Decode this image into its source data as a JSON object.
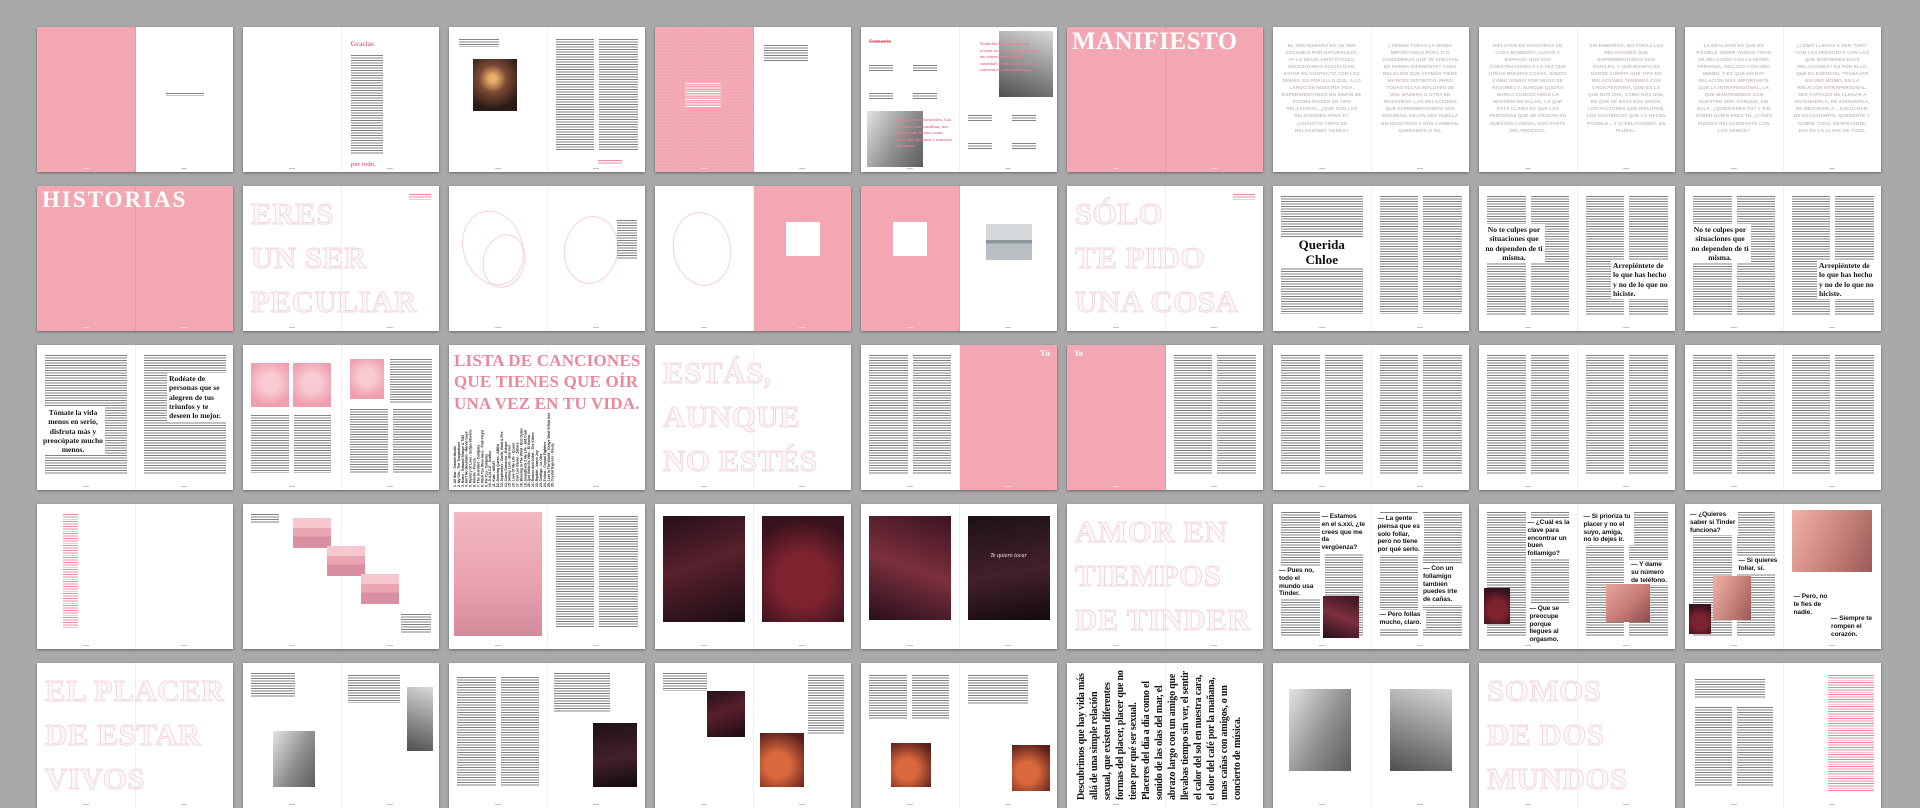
{
  "board": {
    "view": "spread-grid-overview",
    "rows": 5,
    "cols": 9
  },
  "colors": {
    "canvas_grey": "#a9a9aa",
    "page_white": "#ffffff",
    "brand_pink": "#f3a7b3",
    "rose_text": "#e0798b",
    "headline_rose": "#ec7d93",
    "pale_caps": "#c9bbbe",
    "ink": "#141414"
  },
  "spreads": {
    "r1c2": {
      "title": "Gracias",
      "closing": "por todo,"
    },
    "r1c5": {
      "heading": "Sumario",
      "left_note": "Somos seres relacionales. Las relaciones nos cambian, nos construyen. Somos como somos por los lazos y nuestras relaciones.",
      "right_note": "Todas las historias de esta revista son vivencias reales que nos muestran la amplia variedad de relaciones que nos construyen como personas."
    },
    "r1c6": {
      "title": "MANIFIESTO"
    },
    "r1c7": {
      "left": "EL SER HUMANO ES UN SER SOCIABLE POR NATURALEZA. YA LO DECÍA ARISTÓTELES. NECESITAMOS SOCIALIZAR, ESTAR EN CONTACTO CON LOS DEMÁS. ES POR ELLO QUE, A LO LARGO DE NUESTRA VIDA, EXPERIMENTAMOS UN SINFÍN DE POSIBILIDADES DE TIPO RELACIONAL. ¿QUÉ SON LAS RELACIONES PARA TI? ¿CUÁNTOS TIPOS DE RELACIONES TIENES?",
      "right": "¿TIENEN TODAS LA MISMA IMPORTANCIA PARA TI O CONSIDERAS QUE TE AFECTAN DE FORMA DIFERENTE? CADA RELACIÓN QUE VIVIMOS TIENE MATICES DISTINTOS, PERO TODAS ELLAS INFLUYEN DE UNA MANERA U OTRA EN NOSOTROS. LAS RELACIONES QUE EXPERIMENTAMOS NOS MOLDEAN, DEJAN UNA HUELLA EN NOSOTROS Y NOS CAMBIAN, QUERAMOS O NO."
    },
    "r1c8": {
      "left": "INFLUYEN EN NOSOTROS EN CADA MOMENTO, LUGAR Y ESPACIO. NOS VAN CONSTRUYENDO A LA VEZ QUE OTRAS MUCHAS COSAS. SOMOS COMO SOMOS POR MILES DE RAZONES Y, AUNQUE QUIZÁS NUNCA CONOZCAMOS LA MAYORÍA DE ELLAS, LO QUE ESTÁ CLARO ES QUE LAS PERSONAS QUE SE CRUZAN EN NUESTRO CAMINO, SON PARTE DEL PROCESO.",
      "right": "SIN EMBARGO, NO TODAS LAS RELACIONES QUE EXPERIMENTAMOS SON IGUALES, Y QUÉ BONITO ES DARSE CUENTA QUÉ TIPO DE RELACIONES TENEMOS CON CADA PERSONA, QUÉ ES LO QUE NOS UNE, CÓMO NOS UNE, EN QUÉ SE BASA ESA UNIÓN, LOS FACTORES QUE INFLUYEN, LOS SUSTENTOS QUE LO HACEN POSIBLE... Y SI RELACIONES, EN PLURAL."
    },
    "r1c9": {
      "left": "LA REALIDAD ES QUE ES POSIBLE TENER VARIOS TIPOS DE RELACIÓN CON LA MISMA PERSONA, INCLUSO CON UNO MISMO, Y ES QUE NO HAY RELACIÓN MÁS IMPORTANTE QUE LA INTRAPERSONAL, LA QUE MANTENEMOS CON NUESTRO SER. PORQUE, SIN ELLA, ¿QUIÉN ERES TÚ? Y SIN SABER QUIÉN ERES TÚ, ¿CÓMO PUEDES RELACIONARTE CON LOS DEMÁS?",
      "right": "¿CÓMO LLEGAS A SER \"UNO\" CON LAS PERSONAS CON LAS QUE MANTIENES ESAS RELACIONES? ES POR ELLO QUE ES ESENCIAL TRABAJAR EN UNO MISMO, EN LA RELACIÓN INTRAPERSONAL. SER CAPACES DE LLEGAR A ENTENDERLA, DE ATENDERLA, DE MEJORARLA... ESCUCHAR, DE ESCUCHARTE, QUERERTE Y, SOBRE TODO, RESPETARTE. ESA ES LA CLAVE DE TODO."
    },
    "r2c1": {
      "title": "HISTORIAS"
    },
    "r2c2": {
      "title": "ERES\nUN SER\nPECULIAR"
    },
    "r2c6": {
      "title": "SÓLO\nTE PIDO\nUNA COSA"
    },
    "r2c7": {
      "title": "Querida\nChloe"
    },
    "r2c8": {
      "pull_left": "No te culpes por situaciones que no dependen de ti misma.",
      "pull_right": "Arrepiéntete de lo que has hecho y no de lo que no hiciste."
    },
    "r2c9": {
      "pull_left": "No te culpes por situaciones que no dependen de ti misma.",
      "pull_right": "Arrepiéntete de lo que has hecho y no de lo que no hiciste."
    },
    "r3c1": {
      "pull_left": "Tómate la vida menos en serio, disfruta más y preocúpate mucho menos.",
      "pull_right": "Rodéate de personas que se alegren de tus triunfos y te deseen lo mejor."
    },
    "r3c3": {
      "title": "LISTA DE CANCIONES\nQUE TIENES QUE OÍR\nUNA VEZ EN TU VIDA.",
      "songs": [
        "1. All Star - Smash Mouth",
        "2. My Girl - The Temptations",
        "3. Home - Edward Sharpe & TMZ",
        "4. Ain't No Mountain - Marvin Gaye",
        "5. Mystery Of Love - Sufjan Stevens",
        "6. Amelie - Pereza",
        "7. The Scientist - Coldplay",
        "8. Wish You Were Here - Pink Floyd",
        "9. Fix You - Coldplay",
        "10. D.A.N.C.E - Justice",
        "11. Kids - MGMT",
        "12. Dancing Queen - ABBA",
        "13. September - Earth, Wind & Fire",
        "14. Como Camarón - Estopa",
        "15. Skinny Love - Bon Iver",
        "16. Love Of My Life - Queen",
        "17. Con Las Ganas - Zahara",
        "18. Blowing In The Wind - Bob Dylan",
        "19. Soundtrack 2 My Life - Kid Cudi",
        "20. Qué Bello Es Vivir - El Kanka",
        "21. Romeo And Juliet - The Killers",
        "22. Riptide - Vance Joy",
        "23. Contigo - La Otra",
        "24. Follow - Crystal Fighters",
        "25. Lost In The World - Kanye West ft Bon Iver",
        "26. Crystal Express - Raury"
      ]
    },
    "r3c4": {
      "title": "ESTÁS,\nAUNQUE\nNO ESTÉS"
    },
    "r3c5": {
      "label": "Tú"
    },
    "r3c6": {
      "label": "Yo"
    },
    "r4c5": {
      "caption": "Te quiero tocar"
    },
    "r4c6": {
      "title": "AMOR EN\nTIEMPOS\nDE TINDER"
    },
    "r4c7": {
      "quotes": [
        "— Estamos en el s.xxi, ¿te crees que me da vergüenza?",
        "— Pues no, todo el mundo usa Tinder.",
        "— La gente piensa que es solo follar, pero no tiene por qué serlo.",
        "— Con un follamigo también puedes irte de cañas.",
        "— Pero follas mucho, claro."
      ]
    },
    "r4c8": {
      "quotes": [
        "— ¿Cuál es la clave para encontrar un buen follamigo?",
        "— Si prioriza tu placer y no el suyo, amiga, no lo dejes ir.",
        "— Que se preocupe porque llegues al orgasmo.",
        "— Y dame su número de teléfono."
      ]
    },
    "r4c9": {
      "quotes": [
        "— ¿Quieres saber si Tinder funciona?",
        "— Si quieres follar, sí.",
        "— Pero, no te fíes de nadie.",
        "— Siempre te rompen el corazón."
      ]
    },
    "r5c1": {
      "title": "EL PLACER\nDE ESTAR\nVIVOS"
    },
    "r5c6": {
      "text": "Descubrimos que hay vida más allá de una simple relación sexual, que existen diferentes formas del placer, placer que no tiene por qué ser sexual. Placeres del día a día como el sonido de las olas del mar, el abrazo largo con un amigo que llevabas tiempo sin ver, el sentir el calor del sol en nuestra cara, el olor del café por la mañana, unas cañas con amigos, o un concierto de música."
    },
    "r5c8": {
      "title": "SOMOS\nDE DOS\nMUNDOS"
    }
  }
}
